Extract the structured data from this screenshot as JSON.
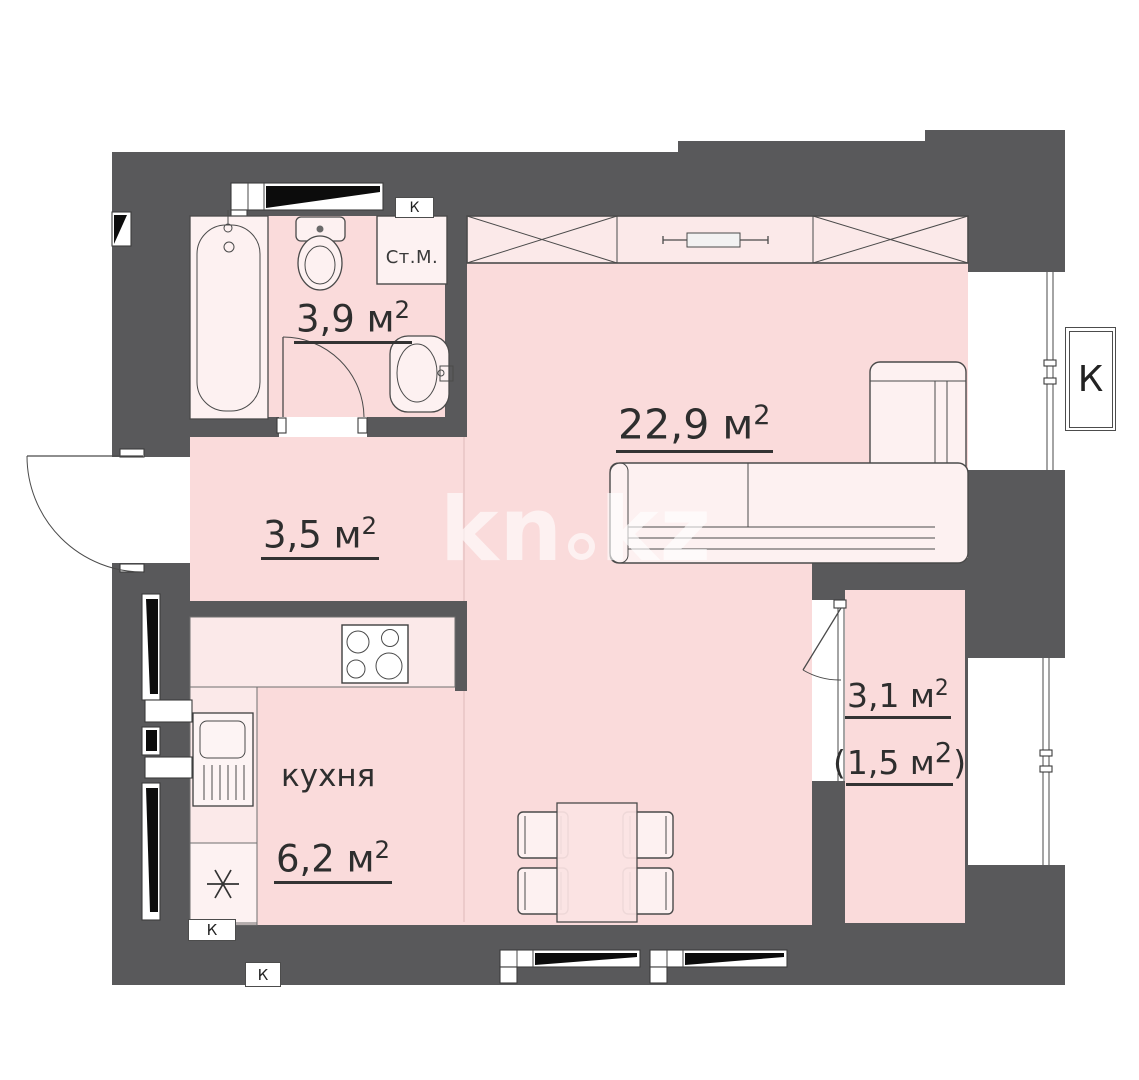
{
  "watermark": {
    "part1": "kn",
    "part2": "kz"
  },
  "rooms": {
    "bathroom": {
      "value": "3,9",
      "unit": "м",
      "sup": "2"
    },
    "hallway": {
      "value": "3,5",
      "unit": "м",
      "sup": "2"
    },
    "living": {
      "value": "22,9",
      "unit": "м",
      "sup": "2"
    },
    "kitchen": {
      "name": "кухня",
      "value": "6,2",
      "unit": "м",
      "sup": "2"
    },
    "balcony": {
      "value": "3,1",
      "unit": "м",
      "sup": "2",
      "alt_open": "(",
      "alt_value": "1,5",
      "alt_unit": "м",
      "alt_sup": "2",
      "alt_close": ")"
    }
  },
  "fixtures": {
    "washing_machine": "Ст.М."
  },
  "vents": {
    "bathroom": "К",
    "kitchen": "К",
    "bottom": "К",
    "right": "К"
  },
  "colors": {
    "wall": "#59595b",
    "room": "#fadbdb",
    "band": "#fbe9e9",
    "furn": "#fdf1f1",
    "line": "#4a4a4a",
    "text": "#2e2e2e"
  }
}
